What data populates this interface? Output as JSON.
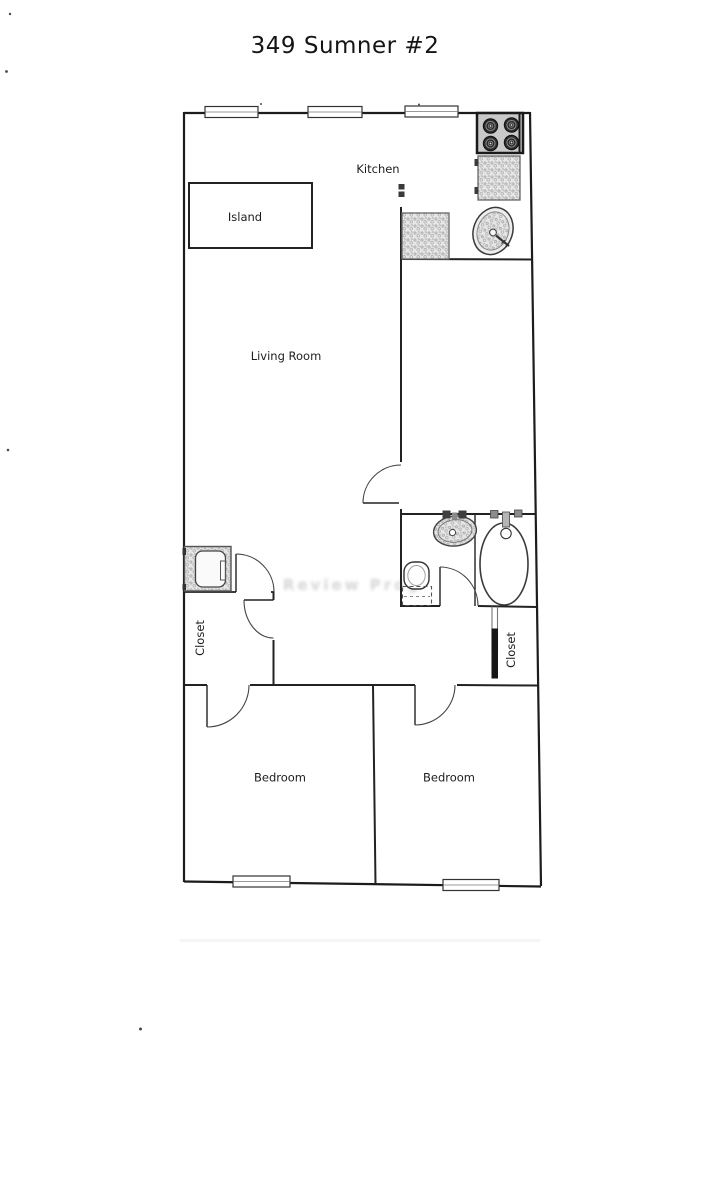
{
  "title": "349 Sumner #2",
  "rooms": {
    "kitchen": "Kitchen",
    "island": "Island",
    "living_room": "Living Room",
    "closet_left": "Closet",
    "closet_right": "Closet",
    "bedroom_left": "Bedroom",
    "bedroom_right": "Bedroom"
  },
  "artifacts": {
    "ghost_text": "Review Prog"
  },
  "fixtures": [
    "stove-icon",
    "kitchen-counter",
    "kitchen-sink-icon",
    "island",
    "washer-icon",
    "bathroom-sink-icon",
    "toilet-icon",
    "bathtub-icon",
    "closet-sliding-door",
    "window",
    "hinged-door"
  ],
  "colors": {
    "wall": "#1c1c1c",
    "counter_fill": "#e6e6e6",
    "stove_fill": "#c9c9c9",
    "appliance_dark": "#2b2b2b",
    "paper": "#ffffff"
  }
}
